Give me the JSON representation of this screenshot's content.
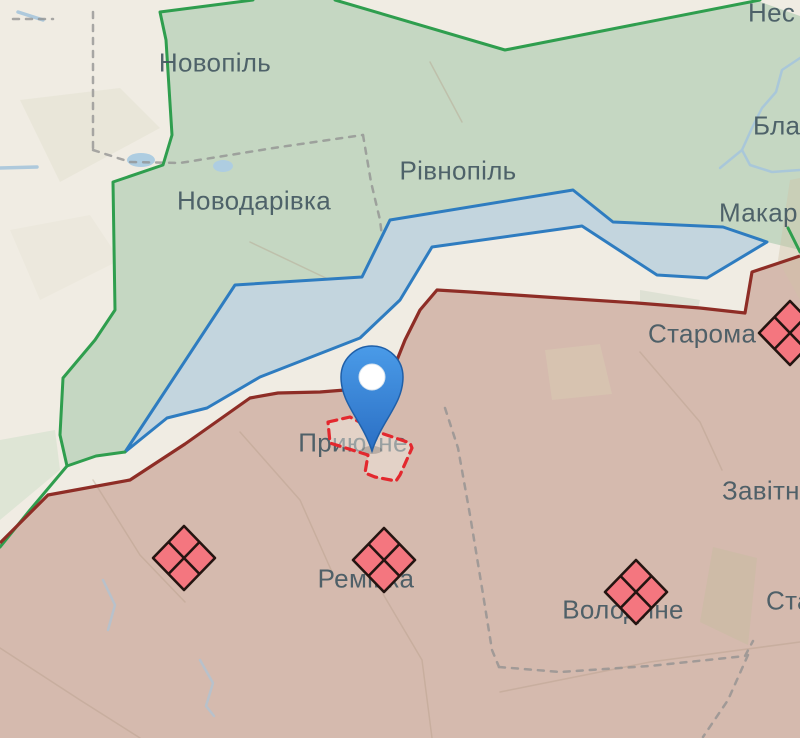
{
  "map": {
    "towns": [
      {
        "id": "novopil",
        "text": "Новопіль"
      },
      {
        "id": "novodarivka",
        "text": "Новодарівка"
      },
      {
        "id": "rivnopil",
        "text": "Рівнопіль"
      },
      {
        "id": "nes",
        "text": "Нес"
      },
      {
        "id": "bla",
        "text": "Бла"
      },
      {
        "id": "makar",
        "text": "Макар"
      },
      {
        "id": "staroma",
        "text": "Старома"
      },
      {
        "id": "zavitn",
        "text": "Завітн"
      },
      {
        "id": "sta",
        "text": "Ста"
      },
      {
        "id": "pryutne",
        "text": "Приютне"
      },
      {
        "id": "remivka",
        "text": "Ремівка"
      },
      {
        "id": "volodyne",
        "text": "Володине"
      }
    ],
    "unit_symbol_count": 4,
    "marker_count": 1,
    "colors": {
      "background": "#f0ece3",
      "green_zone_fill": "#c5d7c2",
      "green_zone_border": "#2f9e4e",
      "blue_zone_fill": "#c3d5de",
      "blue_zone_border": "#2e7cc0",
      "red_zone_fill": "#d5baae",
      "front_line": "#8e2d26",
      "advance_dashed": "#e3282e",
      "admin_boundary": "#8f8f8f",
      "unit_symbol_fill": "#f4767f",
      "unit_symbol_stroke": "#241511",
      "pin_fill": "#3c87da",
      "water": "#a6c6dc",
      "label_text": "#445862"
    }
  }
}
